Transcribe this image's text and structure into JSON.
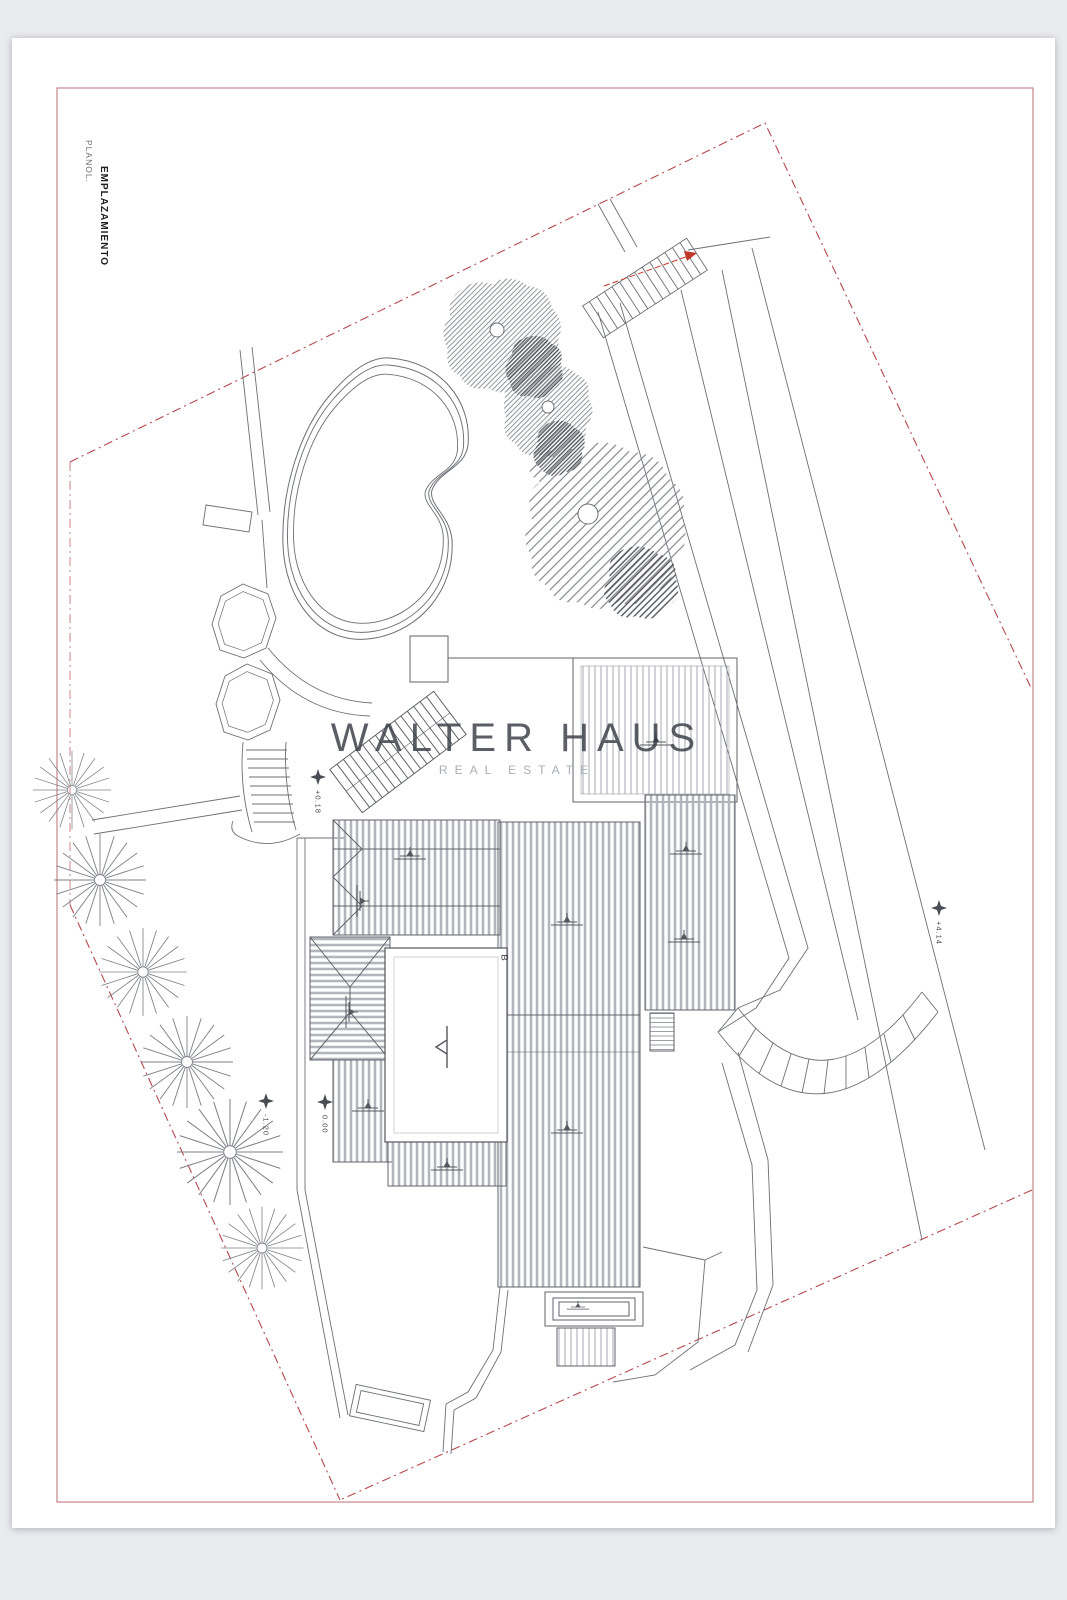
{
  "page": {
    "background_color": "#e9ebef",
    "sheet_color": "#ffffff",
    "frame_color": "#c4868a",
    "boundary_color": "#b5484e",
    "drawing_line_color": "#6b6f75"
  },
  "title_block": {
    "plan_label": "PLANOL.",
    "plan_title": "EMPLAZAMIENTO"
  },
  "watermark": {
    "line1": "WALTER HAUS",
    "line2": "REAL ESTATE",
    "dark_color": "#383d44",
    "light_color": "#a9afb5"
  },
  "annotations": {
    "section_label": "B",
    "elevation_markers": [
      {
        "id": "entry-landing",
        "value": "+0.18"
      },
      {
        "id": "main-terrace",
        "value": "0.00"
      },
      {
        "id": "garden",
        "value": "-1.20"
      },
      {
        "id": "upper-driveway",
        "value": "+4.14"
      }
    ]
  }
}
